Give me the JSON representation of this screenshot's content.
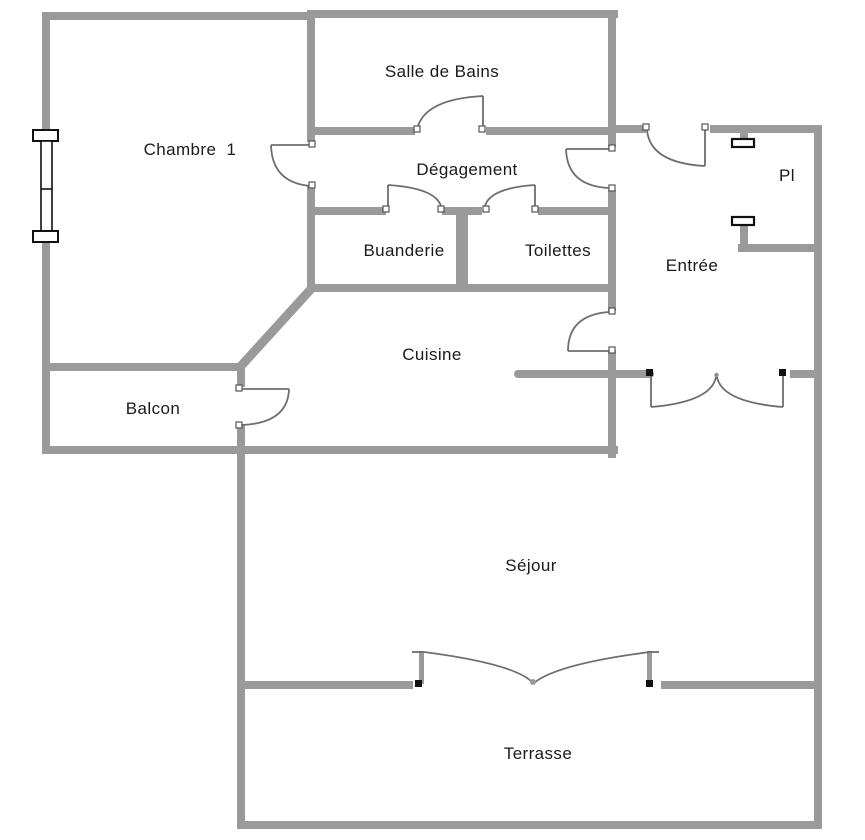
{
  "title": "Plan d'appartement",
  "rooms": {
    "salle_de_bains": {
      "label": "Salle de Bains"
    },
    "chambre1": {
      "label": "Chambre  1"
    },
    "degagement": {
      "label": "Dégagement"
    },
    "pl": {
      "label": "Pl"
    },
    "buanderie": {
      "label": "Buanderie"
    },
    "toilettes": {
      "label": "Toilettes"
    },
    "entree": {
      "label": "Entrée"
    },
    "cuisine": {
      "label": "Cuisine"
    },
    "balcon": {
      "label": "Balcon"
    },
    "sejour": {
      "label": "Séjour"
    },
    "terrasse": {
      "label": "Terrasse"
    }
  },
  "colors": {
    "wall": "#9a9a9a",
    "door_line": "#6e6e6e",
    "symbol_outline": "#111111",
    "label_text": "#1a1a1a",
    "background": "#ffffff"
  },
  "symbols": {
    "window": "double-casement-window on left wall of Chambre 1",
    "single_doors": 8,
    "double_doors": 2,
    "closet_shelf_marks": 2
  }
}
